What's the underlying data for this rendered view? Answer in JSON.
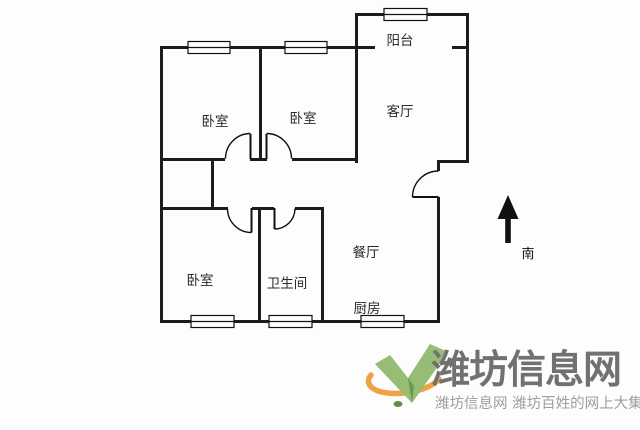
{
  "floor_plan": {
    "rooms": {
      "balcony": {
        "label": "阳台"
      },
      "bedroom_top_left": {
        "label": "卧室"
      },
      "bedroom_top_middle": {
        "label": "卧室"
      },
      "living_room": {
        "label": "客厅"
      },
      "dining_room": {
        "label": "餐厅"
      },
      "bedroom_bottom_left": {
        "label": "卧室"
      },
      "bathroom": {
        "label": "卫生间"
      },
      "kitchen": {
        "label": "厨房"
      }
    },
    "compass": {
      "label": "南",
      "icon": "up-arrow-icon"
    }
  },
  "watermark": {
    "site_name": "潍坊信息网",
    "tagline": "潍坊信息网 潍坊百姓的网上大集",
    "logo_icon": "green-v-leaf-with-orange-swoosh-icon"
  },
  "colors": {
    "wall": "#1c1c1c",
    "logo_green": "#96BD75",
    "logo_green_dark": "#6E9A50",
    "logo_orange": "#EFA243",
    "logo_text": "#717171",
    "logo_tagline": "#9E9E9E"
  }
}
